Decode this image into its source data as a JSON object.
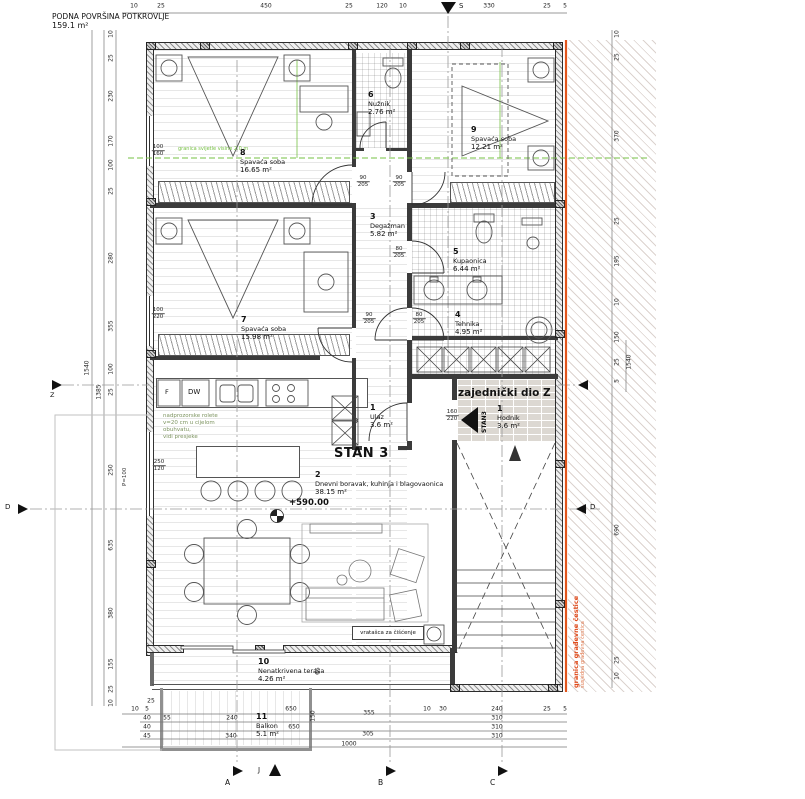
{
  "header": {
    "line1": "PODNA POVRŠINA POTKROVLJE",
    "line2": "159.1 m²"
  },
  "plan": {
    "stan_label": "STAN 3",
    "common_label": "zajednički dio Z",
    "stan_arrow_label": "STAN3",
    "elevation": "+590.00",
    "cleaning_hatch": "vratašca za čišćenje",
    "appliance_dw": "DW",
    "appliance_f": "F",
    "parapet_note": "P=100",
    "green_note": "nadprozorske rolete\nv=20 cm u cijelom\nobuhvatu,\nvidi presjeke",
    "green_boundary": "granica svijetle visine 2.0 m",
    "plot_line1": "granica građevne čestice",
    "plot_line2": "susjedna građevna čestica",
    "compass": {
      "north": "S",
      "south": "J",
      "west": "Z"
    },
    "grid": {
      "a": "A",
      "b": "B",
      "c": "C",
      "d": "D"
    },
    "colors": {
      "accent_green": "#76c043",
      "boundary_orange": "#e2551c",
      "line_dark": "#3b3b3b"
    }
  },
  "rooms": [
    {
      "num": "8",
      "name": "Spavaća soba",
      "area": "16.65 m²",
      "x": 240,
      "y": 148
    },
    {
      "num": "6",
      "name": "Nužnik",
      "area": "2.76 m²",
      "x": 368,
      "y": 90
    },
    {
      "num": "9",
      "name": "Spavaća soba",
      "area": "12.21 m²",
      "x": 471,
      "y": 125
    },
    {
      "num": "3",
      "name": "Degažman",
      "area": "5.82 m²",
      "x": 370,
      "y": 212
    },
    {
      "num": "5",
      "name": "Kupaonica",
      "area": "6.44 m²",
      "x": 453,
      "y": 247
    },
    {
      "num": "4",
      "name": "Tehnika",
      "area": "4.95 m²",
      "x": 455,
      "y": 310
    },
    {
      "num": "7",
      "name": "Spavaća soba",
      "area": "15.98 m²",
      "x": 241,
      "y": 315
    },
    {
      "num": "1",
      "name": "Ulaz",
      "area": "3.6 m²",
      "x": 370,
      "y": 403
    },
    {
      "num": "1",
      "name": "Hodnik",
      "area": "3.6 m²",
      "x": 497,
      "y": 404
    },
    {
      "num": "2",
      "name": "Dnevni boravak, kuhinja i blagovaonica",
      "area": "38.15 m²",
      "x": 315,
      "y": 470
    },
    {
      "num": "10",
      "name": "Nenatkrivena terasa",
      "area": "4.26 m²",
      "x": 258,
      "y": 657
    },
    {
      "num": "11",
      "name": "Balkon",
      "area": "5.1 m²",
      "x": 256,
      "y": 712
    }
  ],
  "door_labels": [
    {
      "a": "90",
      "b": "205",
      "x": 363,
      "y": 182
    },
    {
      "a": "90",
      "b": "205",
      "x": 399,
      "y": 182
    },
    {
      "a": "80",
      "b": "205",
      "x": 399,
      "y": 253
    },
    {
      "a": "90",
      "b": "205",
      "x": 369,
      "y": 319
    },
    {
      "a": "80",
      "b": "205",
      "x": 419,
      "y": 319
    },
    {
      "a": "160",
      "b": "220",
      "x": 452,
      "y": 416
    },
    {
      "a": "100",
      "b": "160",
      "x": 158,
      "y": 151
    },
    {
      "a": "100",
      "b": "220",
      "x": 158,
      "y": 314
    },
    {
      "a": "250",
      "b": "120",
      "x": 159,
      "y": 466
    }
  ],
  "dims": {
    "top": [
      {
        "v": "10",
        "x": 134,
        "y": 6
      },
      {
        "v": "25",
        "x": 161,
        "y": 6
      },
      {
        "v": "450",
        "x": 266,
        "y": 6
      },
      {
        "v": "25",
        "x": 349,
        "y": 6
      },
      {
        "v": "120",
        "x": 382,
        "y": 6
      },
      {
        "v": "10",
        "x": 403,
        "y": 6
      },
      {
        "v": "330",
        "x": 489,
        "y": 6
      },
      {
        "v": "25",
        "x": 547,
        "y": 6
      },
      {
        "v": "5",
        "x": 565,
        "y": 6
      }
    ],
    "left": [
      {
        "v": "10",
        "x": 111,
        "y": 34,
        "rot": 1
      },
      {
        "v": "25",
        "x": 111,
        "y": 58,
        "rot": 1
      },
      {
        "v": "230",
        "x": 111,
        "y": 96,
        "rot": 1
      },
      {
        "v": "170",
        "x": 111,
        "y": 141,
        "rot": 1
      },
      {
        "v": "100",
        "x": 111,
        "y": 165,
        "rot": 1
      },
      {
        "v": "25",
        "x": 111,
        "y": 191,
        "rot": 1
      },
      {
        "v": "280",
        "x": 111,
        "y": 258,
        "rot": 1
      },
      {
        "v": "355",
        "x": 111,
        "y": 326,
        "rot": 1
      },
      {
        "v": "100",
        "x": 111,
        "y": 369,
        "rot": 1
      },
      {
        "v": "25",
        "x": 111,
        "y": 392,
        "rot": 1
      },
      {
        "v": "250",
        "x": 111,
        "y": 470,
        "rot": 1
      },
      {
        "v": "635",
        "x": 111,
        "y": 545,
        "rot": 1
      },
      {
        "v": "380",
        "x": 111,
        "y": 613,
        "rot": 1
      },
      {
        "v": "155",
        "x": 111,
        "y": 664,
        "rot": 1
      },
      {
        "v": "25",
        "x": 111,
        "y": 689,
        "rot": 1
      },
      {
        "v": "10",
        "x": 111,
        "y": 703,
        "rot": 1
      },
      {
        "v": "1385",
        "x": 99,
        "y": 392,
        "rot": 1
      },
      {
        "v": "1540",
        "x": 87,
        "y": 368,
        "rot": 1
      }
    ],
    "right": [
      {
        "v": "10",
        "x": 617,
        "y": 34,
        "rot": 1
      },
      {
        "v": "25",
        "x": 617,
        "y": 57,
        "rot": 1
      },
      {
        "v": "370",
        "x": 617,
        "y": 136,
        "rot": 1
      },
      {
        "v": "25",
        "x": 617,
        "y": 221,
        "rot": 1
      },
      {
        "v": "195",
        "x": 617,
        "y": 261,
        "rot": 1
      },
      {
        "v": "10",
        "x": 617,
        "y": 302,
        "rot": 1
      },
      {
        "v": "150",
        "x": 617,
        "y": 337,
        "rot": 1
      },
      {
        "v": "25",
        "x": 617,
        "y": 362,
        "rot": 1
      },
      {
        "v": "5",
        "x": 617,
        "y": 381,
        "rot": 1
      },
      {
        "v": "690",
        "x": 617,
        "y": 530,
        "rot": 1
      },
      {
        "v": "25",
        "x": 617,
        "y": 660,
        "rot": 1
      },
      {
        "v": "10",
        "x": 617,
        "y": 676,
        "rot": 1
      },
      {
        "v": "1540",
        "x": 629,
        "y": 362,
        "rot": 1
      }
    ],
    "bottom": [
      {
        "v": "25",
        "x": 151,
        "y": 701
      },
      {
        "v": "10",
        "x": 135,
        "y": 709
      },
      {
        "v": "5",
        "x": 147,
        "y": 709
      },
      {
        "v": "650",
        "x": 291,
        "y": 709
      },
      {
        "v": "355",
        "x": 369,
        "y": 713
      },
      {
        "v": "10",
        "x": 427,
        "y": 709
      },
      {
        "v": "30",
        "x": 443,
        "y": 709
      },
      {
        "v": "240",
        "x": 497,
        "y": 709
      },
      {
        "v": "25",
        "x": 547,
        "y": 709
      },
      {
        "v": "5",
        "x": 565,
        "y": 709
      },
      {
        "v": "40",
        "x": 147,
        "y": 718
      },
      {
        "v": "55",
        "x": 167,
        "y": 718
      },
      {
        "v": "240",
        "x": 232,
        "y": 718
      },
      {
        "v": "310",
        "x": 497,
        "y": 718
      },
      {
        "v": "40",
        "x": 147,
        "y": 727
      },
      {
        "v": "650",
        "x": 294,
        "y": 727
      },
      {
        "v": "310",
        "x": 497,
        "y": 727
      },
      {
        "v": "45",
        "x": 147,
        "y": 736
      },
      {
        "v": "340",
        "x": 231,
        "y": 736
      },
      {
        "v": "305",
        "x": 368,
        "y": 734
      },
      {
        "v": "310",
        "x": 497,
        "y": 736
      },
      {
        "v": "1000",
        "x": 349,
        "y": 744
      },
      {
        "v": "150",
        "x": 313,
        "y": 716,
        "rot": 1
      },
      {
        "v": "65",
        "x": 318,
        "y": 671,
        "rot": 1
      }
    ]
  }
}
